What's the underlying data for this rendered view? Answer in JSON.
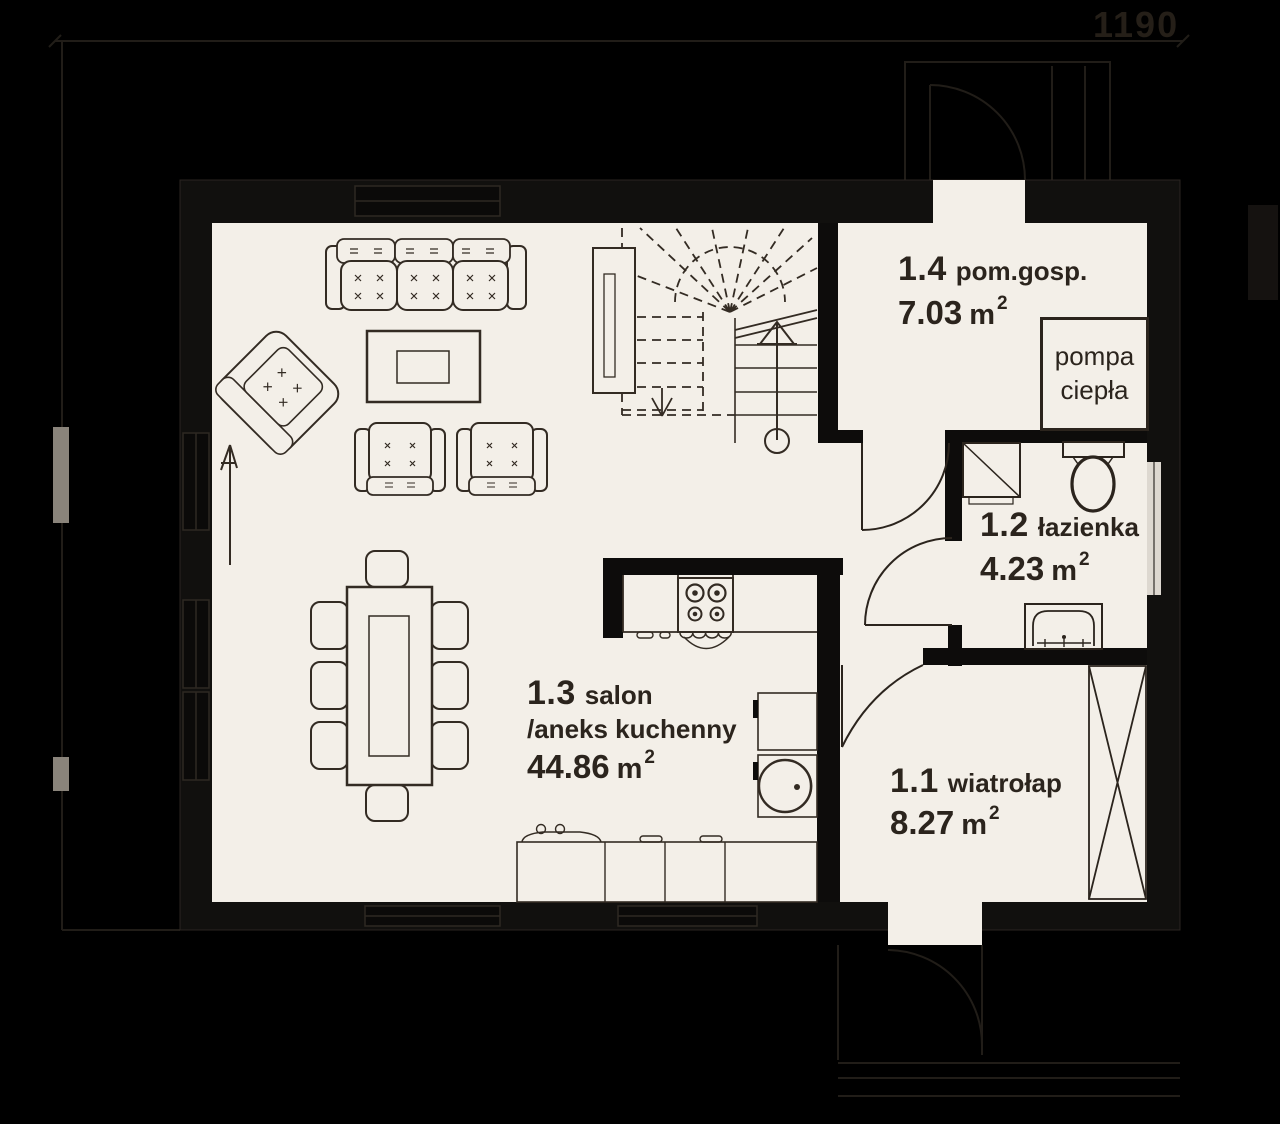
{
  "plan": {
    "rooms": [
      {
        "num": "1.1",
        "name": "wiatrołap",
        "area": "8.27",
        "unit": "m",
        "sup": "2"
      },
      {
        "num": "1.2",
        "name": "łazienka",
        "area": "4.23",
        "unit": "m",
        "sup": "2"
      },
      {
        "num": "1.3",
        "name": "salon",
        "name2": "/aneks kuchenny",
        "area": "44.86",
        "unit": "m",
        "sup": "2"
      },
      {
        "num": "1.4",
        "name": "pom.gosp.",
        "area": "7.03",
        "unit": "m",
        "sup": "2"
      }
    ],
    "labels": {
      "heat_pump": [
        "pompa",
        "ciepła"
      ]
    },
    "dimensions": {
      "top": "1190"
    },
    "colors": {
      "background": "#000000",
      "floor": "#f3efe8",
      "ink": "#2b241d",
      "wall": "#0d0c0b",
      "faint": "#211d18"
    }
  }
}
